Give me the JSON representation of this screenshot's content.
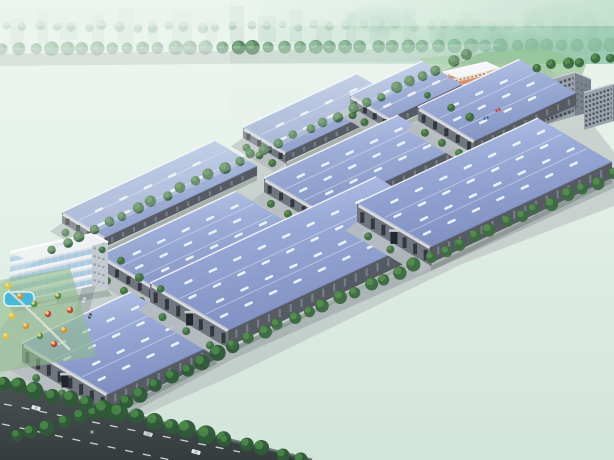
{
  "meta": {
    "type": "architectural-aerial-rendering",
    "subject": "industrial logistics park with blue-roofed warehouses"
  },
  "scene": {
    "canvas": {
      "w": 614,
      "h": 460
    },
    "colors": {
      "sky_top": "#ecf5ee",
      "sky_bot": "#d2e5da",
      "teal1": "#bedcca",
      "teal2": "#94c8ae",
      "city": "#b7ccc3",
      "bg_tree": "#4d7d56",
      "bg_tree_far": "#7fa98a",
      "bg_road": "#a9b4b1",
      "park1": "#a6cfa2",
      "park2": "#8abd8c",
      "field_light": "#c8dcae",
      "lake": "#b5cfc9",
      "path": "#dce6d0",
      "cluster_out": "#45784c",
      "cluster_in": "#5d9560",
      "ground": "#b4babc",
      "apron": "#b7bdbf",
      "road": "#a9b1b3",
      "plaza_dark": "#6e777d",
      "roof_light": "#b9c7e8",
      "roof_mid": "#97a8d6",
      "roof_dark": "#8090c2",
      "skylight": "#eef4fa",
      "ridge": "#ffffff",
      "wall_front": "#70757e",
      "wall_side": "#565b63",
      "wall_band": "#dfe3e8",
      "window": "#30353d",
      "side_slit": "#7d848e",
      "tree_dark": "#3e6b44",
      "tree_light": "#57904f",
      "verge_dark": "#2f5a38",
      "verge_light": "#4a8a48",
      "field1": "#2a5c3d",
      "field2": "#132e24",
      "ghost": "#2f6a4b",
      "ghost_lake": "#1d4a3d",
      "highway1": "#41494b",
      "highway2": "#343c3e",
      "lane_mark": "#e8ecec",
      "office_front": "#eef2f5",
      "office_side": "#c3cad1",
      "glass": "#9ec3dc",
      "band": "#d9dfe4",
      "pink_wall": "#efe0cf",
      "pink_band": "#d2845c",
      "pink_side": "#d8c2ae",
      "white_roof": "#f4f6f7",
      "fountain_water": "#45b7e3",
      "fountain_rim": "#eef4f6",
      "sculpture": "#d8a43c",
      "gray_front": "#9aa2ab",
      "gray_side": "#7a828b",
      "highrise": "#d9b364",
      "highrise_side": "#b8924e",
      "pool": "#49b8d8",
      "haze": "#eef6f2"
    },
    "bg": {
      "city_rects": [
        [
          10,
          18,
          14,
          26
        ],
        [
          38,
          10,
          10,
          34
        ],
        [
          60,
          22,
          18,
          18
        ],
        [
          92,
          14,
          12,
          30
        ],
        [
          118,
          8,
          16,
          36
        ],
        [
          148,
          20,
          10,
          22
        ],
        [
          172,
          12,
          20,
          30
        ],
        [
          205,
          18,
          12,
          24
        ],
        [
          230,
          6,
          14,
          38
        ],
        [
          258,
          16,
          18,
          26
        ],
        [
          290,
          10,
          12,
          32
        ],
        [
          316,
          20,
          16,
          22
        ],
        [
          346,
          12,
          10,
          30
        ],
        [
          370,
          16,
          20,
          26
        ],
        [
          404,
          8,
          12,
          34
        ],
        [
          430,
          18,
          16,
          24
        ],
        [
          462,
          12,
          12,
          30
        ],
        [
          490,
          20,
          18,
          20
        ],
        [
          524,
          10,
          12,
          32
        ],
        [
          552,
          16,
          16,
          26
        ],
        [
          584,
          12,
          14,
          30
        ]
      ],
      "tree_row_far": {
        "from": [
          6,
          27
        ],
        "to": [
          608,
          25
        ],
        "n": 38,
        "r": 4.5
      },
      "tree_row_near": {
        "from": [
          4,
          49
        ],
        "to": [
          610,
          45
        ],
        "n": 40,
        "r": 6.5
      },
      "road_band": [
        [
          0,
          54
        ],
        [
          614,
          46
        ],
        [
          614,
          60
        ],
        [
          0,
          66
        ]
      ]
    },
    "park": {
      "poly": [
        [
          0,
          48
        ],
        [
          500,
          44
        ],
        [
          52,
          252
        ],
        [
          0,
          284
        ]
      ],
      "fields": [
        [
          [
            12,
            142
          ],
          [
            88,
            118
          ],
          [
            146,
            158
          ],
          [
            62,
            196
          ]
        ],
        [
          [
            150,
            168
          ],
          [
            232,
            138
          ],
          [
            284,
            170
          ],
          [
            200,
            206
          ]
        ],
        [
          [
            226,
            92
          ],
          [
            300,
            76
          ],
          [
            342,
            98
          ],
          [
            278,
            120
          ]
        ],
        [
          [
            60,
            220
          ],
          [
            130,
            196
          ],
          [
            168,
            222
          ],
          [
            96,
            248
          ]
        ]
      ],
      "lake": [
        [
          46,
          118
        ],
        [
          100,
          106
        ],
        [
          160,
          118
        ],
        [
          172,
          130
        ],
        [
          120,
          142
        ],
        [
          58,
          136
        ]
      ],
      "stream": "M170,56 C158,78 152,88 138,100 C124,112 120,124 124,138",
      "paths": [
        "M20,130 C80,152 160,150 240,120",
        "M60,230 C120,210 180,200 260,170"
      ],
      "clusters": [
        [
          30,
          100
        ],
        [
          75,
          95
        ],
        [
          120,
          88
        ],
        [
          170,
          90
        ],
        [
          210,
          100
        ],
        [
          48,
          160
        ],
        [
          100,
          165
        ],
        [
          150,
          180
        ],
        [
          200,
          170
        ],
        [
          250,
          150
        ],
        [
          300,
          120
        ],
        [
          260,
          105
        ],
        [
          90,
          210
        ],
        [
          140,
          215
        ],
        [
          35,
          195
        ],
        [
          330,
          95
        ],
        [
          310,
          140
        ],
        [
          230,
          190
        ],
        [
          180,
          230
        ],
        [
          130,
          245
        ]
      ],
      "ghost_slabs": [
        [
          238,
          60,
          16,
          40
        ],
        [
          262,
          66,
          14,
          34
        ],
        [
          288,
          70,
          14,
          30
        ],
        [
          312,
          74,
          12,
          28
        ],
        [
          336,
          78,
          10,
          24
        ],
        [
          228,
          84,
          22,
          16
        ],
        [
          256,
          96,
          18,
          12
        ]
      ],
      "highrise": {
        "p": [
          200,
          74
        ]
      }
    },
    "ground_poly": [
      [
        40,
        252
      ],
      [
        300,
        130
      ],
      [
        468,
        52
      ],
      [
        548,
        66
      ],
      [
        614,
        152
      ],
      [
        614,
        206
      ],
      [
        462,
        264
      ],
      [
        236,
        374
      ],
      [
        110,
        430
      ],
      [
        60,
        442
      ],
      [
        6,
        452
      ],
      [
        0,
        436
      ],
      [
        0,
        330
      ],
      [
        22,
        300
      ]
    ],
    "lawn_poly": [
      [
        420,
        58
      ],
      [
        536,
        48
      ],
      [
        588,
        60
      ],
      [
        580,
        80
      ],
      [
        438,
        104
      ]
    ],
    "roads": {
      "nw_fence": {
        "from": [
          50,
          254
        ],
        "to": [
          468,
          58
        ]
      },
      "se_band": {
        "pts": [
          [
            12,
            436
          ],
          [
            110,
            412
          ],
          [
            233,
            347
          ],
          [
            357,
            292
          ],
          [
            460,
            246
          ],
          [
            614,
            176
          ]
        ],
        "w": 12
      },
      "cross_poly": [
        [
          96,
          238
        ],
        [
          108,
          238
        ],
        [
          84,
          332
        ],
        [
          70,
          330
        ]
      ],
      "entrance_poly": [
        [
          488,
          84
        ],
        [
          560,
          84
        ],
        [
          566,
          118
        ],
        [
          498,
          124
        ]
      ],
      "entrance_arm": [
        [
          497,
          104
        ],
        [
          512,
          114
        ],
        [
          472,
          148
        ],
        [
          457,
          136
        ]
      ]
    },
    "lanes": [
      {
        "depth": 50,
        "wall_h": 11,
        "haze": 0.18,
        "buildings": [
          {
            "p": [
              62,
              212
            ],
            "len": 168
          },
          {
            "p": [
              243,
              127
            ],
            "len": 125
          },
          {
            "p": [
              350,
              95
            ],
            "len": 80,
            "depth": 46
          }
        ]
      },
      {
        "depth": 66,
        "wall_h": 14,
        "haze": 0.08,
        "buildings": [
          {
            "p": [
              100,
              255
            ],
            "len": 150
          },
          {
            "p": [
              264,
              178
            ],
            "len": 148
          },
          {
            "p": [
              418,
              107
            ],
            "len": 112
          }
        ]
      },
      {
        "depth": 95,
        "wall_h": 19,
        "haze": 0,
        "buildings": [
          {
            "p": [
              22,
              343
            ],
            "len": 120,
            "depth": 100
          },
          {
            "p": [
              150,
              283
            ],
            "len": 250,
            "depth": 92
          },
          {
            "p": [
              357,
              203
            ],
            "len": 200,
            "depth": 86
          }
        ]
      }
    ],
    "landmarks": {
      "office": {
        "p": [
          8,
          226
        ]
      },
      "pink": {
        "p": [
          443,
          58
        ]
      },
      "gate": {
        "p": [
          494,
          72
        ]
      },
      "fountain": {
        "c": [
          512,
          97
        ]
      },
      "flags": [
        [
          528,
          78
        ],
        [
          533,
          81
        ],
        [
          538,
          84
        ]
      ],
      "gray_blocks": [
        {
          "p": [
            541,
            72
          ],
          "s": 1
        },
        {
          "p": [
            584,
            84
          ],
          "s": 0.85
        }
      ]
    },
    "plaza": {
      "pool": [
        4,
        292,
        30,
        14
      ],
      "trees": [
        [
          8,
          286
        ],
        [
          20,
          296
        ],
        [
          34,
          304
        ],
        [
          48,
          314
        ],
        [
          12,
          316
        ],
        [
          26,
          326
        ],
        [
          40,
          336
        ],
        [
          54,
          344
        ],
        [
          6,
          336
        ],
        [
          64,
          330
        ],
        [
          58,
          296
        ],
        [
          70,
          310
        ]
      ],
      "tree_colors": [
        "#e3c02f",
        "#d8912c",
        "#4f8b3e",
        "#c23e2e"
      ]
    },
    "tree_rows": [
      {
        "from": [
          52,
          248
        ],
        "to": [
          466,
          56
        ],
        "n": 30,
        "r": 5,
        "c": "dark"
      },
      {
        "from": [
          15,
          434
        ],
        "to": [
          110,
          410
        ],
        "n": 7,
        "r": 7,
        "c": "verge"
      },
      {
        "from": [
          110,
          410
        ],
        "to": [
          233,
          346
        ],
        "n": 9,
        "r": 7,
        "c": "verge"
      },
      {
        "from": [
          233,
          346
        ],
        "to": [
          460,
          244
        ],
        "n": 16,
        "r": 6,
        "c": "dark"
      },
      {
        "from": [
          460,
          244
        ],
        "to": [
          612,
          175
        ],
        "n": 11,
        "r": 6,
        "c": "dark"
      },
      {
        "from": [
          2,
          382
        ],
        "to": [
          222,
          438
        ],
        "n": 14,
        "r": 8,
        "c": "verge"
      },
      {
        "from": [
          226,
          440
        ],
        "to": [
          300,
          458
        ],
        "n": 5,
        "r": 7,
        "c": "verge"
      },
      {
        "from": [
          536,
          68
        ],
        "to": [
          612,
          58
        ],
        "n": 6,
        "r": 5,
        "c": "dark"
      },
      {
        "from": [
          430,
          96
        ],
        "to": [
          468,
          118
        ],
        "n": 3,
        "r": 4,
        "c": "dark"
      },
      {
        "from": [
          102,
          248
        ],
        "to": [
          160,
          290
        ],
        "n": 4,
        "r": 4,
        "c": "dark"
      }
    ],
    "field": {
      "poly": [
        [
          118,
          426
        ],
        [
          240,
          370
        ],
        [
          465,
          260
        ],
        [
          614,
          200
        ],
        [
          614,
          460
        ],
        [
          300,
          460
        ],
        [
          230,
          442
        ]
      ],
      "ghost_lake": [
        [
          420,
          332
        ],
        [
          500,
          318
        ],
        [
          560,
          340
        ],
        [
          540,
          372
        ],
        [
          460,
          374
        ]
      ],
      "ghost_paths": [
        "M330,430 C400,390 480,330 560,290",
        "M360,442 C430,412 520,360 600,330"
      ],
      "ghost_trees": [
        [
          340,
          420
        ],
        [
          370,
          400
        ],
        [
          400,
          380
        ],
        [
          430,
          360
        ],
        [
          460,
          340
        ],
        [
          500,
          320
        ],
        [
          530,
          300
        ],
        [
          560,
          285
        ],
        [
          390,
          430
        ],
        [
          450,
          400
        ],
        [
          510,
          370
        ],
        [
          560,
          345
        ],
        [
          590,
          320
        ]
      ],
      "specks": [
        [
          478,
          252
        ],
        [
          520,
          242
        ],
        [
          552,
          230
        ],
        [
          585,
          275
        ]
      ]
    },
    "highway": {
      "poly": [
        [
          0,
          380
        ],
        [
          230,
          440
        ],
        [
          312,
          460
        ],
        [
          0,
          460
        ]
      ],
      "edge": "M0,380 L230,440 L312,460",
      "dashes": [
        "M4,404 L240,452",
        "M2,424 L180,462"
      ]
    },
    "cars_highway": [
      {
        "p": [
          36,
          408
        ],
        "a": 15,
        "c": "#e8ecef"
      },
      {
        "p": [
          92,
          432
        ],
        "a": 15,
        "c": "#3e474b"
      },
      {
        "p": [
          148,
          434
        ],
        "a": 15,
        "c": "#cfd6da"
      },
      {
        "p": [
          196,
          452
        ],
        "a": 15,
        "c": "#e8ecef"
      }
    ],
    "cars_small": [
      {
        "p": [
          84,
          300
        ],
        "a": -70,
        "c": "#dfe5e8"
      },
      {
        "p": [
          90,
          316
        ],
        "a": -70,
        "c": "#3e474b"
      },
      {
        "p": [
          498,
          110
        ],
        "a": -20,
        "c": "#c23e2e"
      },
      {
        "p": [
          486,
          118
        ],
        "a": -20,
        "c": "#3366aa"
      }
    ],
    "people": [
      [
        500,
        106
      ],
      [
        516,
        108
      ],
      [
        524,
        104
      ],
      [
        504,
        112
      ],
      [
        496,
        92
      ],
      [
        530,
        96
      ],
      [
        508,
        116
      ]
    ]
  }
}
